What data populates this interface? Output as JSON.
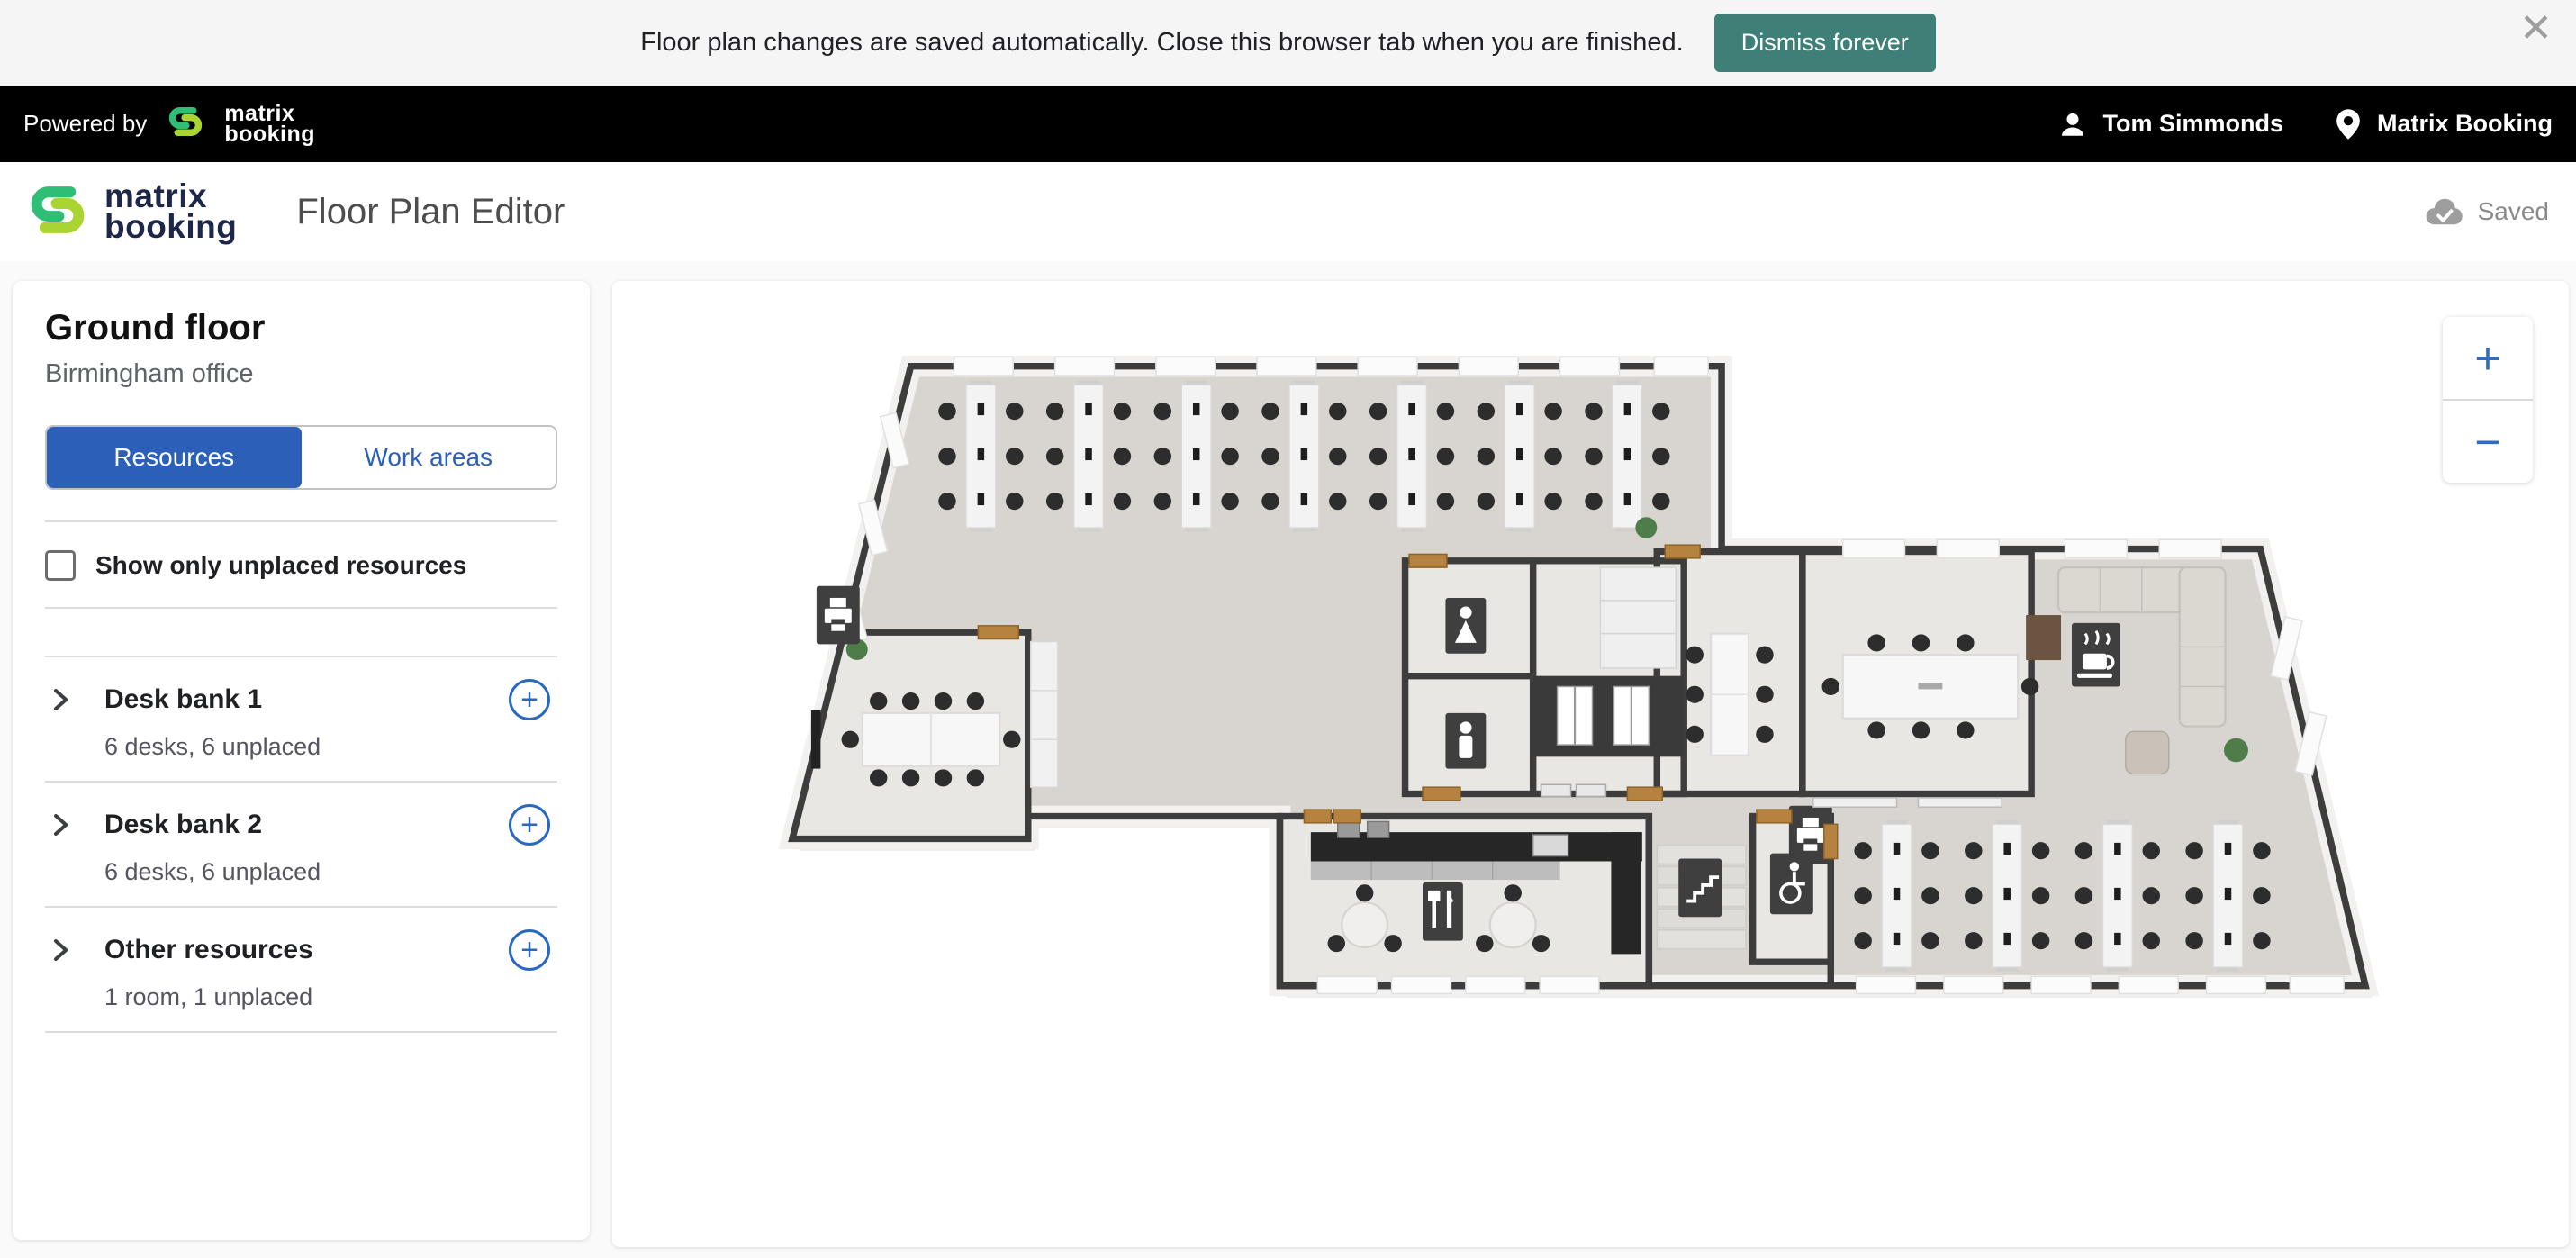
{
  "banner": {
    "message": "Floor plan changes are saved automatically. Close this browser tab when you are finished.",
    "dismiss_label": "Dismiss forever",
    "close_glyph": "✕"
  },
  "topbar": {
    "powered_by": "Powered by",
    "brand_line1": "matrix",
    "brand_line2": "booking",
    "user_name": "Tom Simmonds",
    "org_name": "Matrix Booking"
  },
  "header": {
    "brand_line1": "matrix",
    "brand_line2": "booking",
    "title": "Floor Plan Editor",
    "saved_status": "Saved"
  },
  "sidebar": {
    "floor_name": "Ground floor",
    "location_name": "Birmingham office",
    "tabs": {
      "resources": "Resources",
      "work_areas": "Work areas"
    },
    "filter_label": "Show only unplaced resources",
    "items": [
      {
        "name": "Desk bank 1",
        "details": "6 desks, 6 unplaced"
      },
      {
        "name": "Desk bank 2",
        "details": "6 desks, 6 unplaced"
      },
      {
        "name": "Other resources",
        "details": "1 room, 1 unplaced"
      }
    ]
  },
  "canvas": {
    "zoom_in_glyph": "+",
    "zoom_out_glyph": "−"
  },
  "colors": {
    "accent_blue": "#2b5fb8",
    "add_button_blue": "#2a68c0",
    "dismiss_teal": "#3e7f78",
    "brand_green": "#2fbe76",
    "brand_lime": "#a9d431",
    "wall": "#3d3d3d",
    "door": "#b5823f",
    "floor": "#d8d4cf"
  },
  "floorplan_icons": {
    "printer": "printer-sign",
    "female_wc": "female-wc-sign",
    "male_wc": "male-wc-sign",
    "coffee": "coffee-sign",
    "cutlery": "cutlery-sign",
    "stairs": "stairs-sign",
    "accessible_wc": "accessible-wc-sign",
    "elevator": "elevator-doors"
  }
}
